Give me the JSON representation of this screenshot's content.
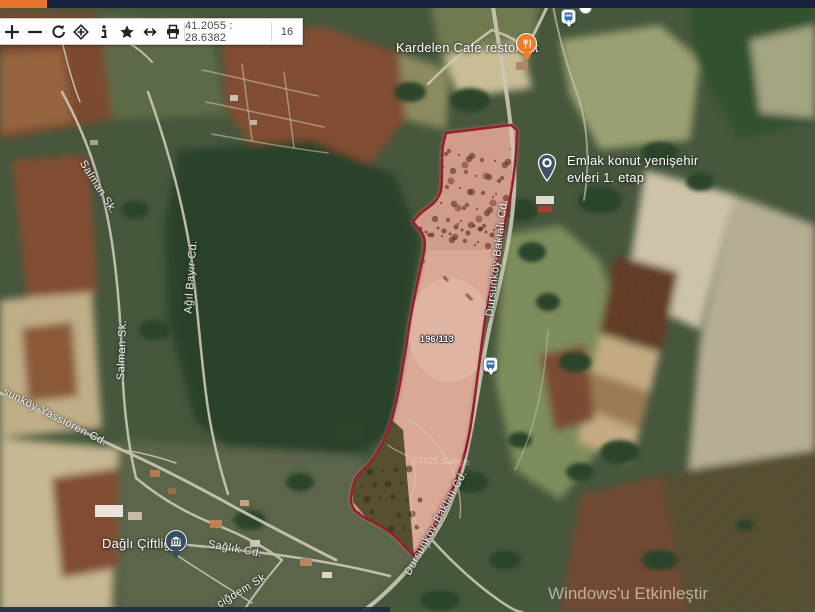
{
  "chrome": {
    "topbar_color": "#17233e",
    "tab_color": "#e8732a"
  },
  "toolbar": {
    "icons": [
      "zoom-in",
      "zoom-out",
      "refresh",
      "locate",
      "info",
      "favorite",
      "measure",
      "print"
    ],
    "coordinates": "41.2055 : 28.6382",
    "zoom_level": "16"
  },
  "map": {
    "markers": {
      "cafe": {
        "label": "Kardelen Cafe restorant",
        "color": "#f07d26"
      },
      "estate": {
        "line1": "Emlak konut yenişehir",
        "line2": "evleri 1. etap",
        "color": "#3d5266"
      },
      "farm": {
        "label": "Dağlı Çiftliği",
        "color": "#33505f"
      }
    },
    "parcel": {
      "number": "196/113",
      "stroke_color": "#9d1c2c"
    },
    "roads": {
      "baklali_upper": "Dursunköy-Baklalı Cd.",
      "baklali_lower": "Dursunköy-Baklalı Cd.",
      "salman_upper": "Salman Sk.",
      "salman_lower": "Salman Sk.",
      "agil_bayir": "Ağıl Bayır Cd.",
      "yassioren": "sunköy-Yassiören Cd.",
      "saglik": "Sağlık Cd.",
      "cigdem": "çiğdem Sk."
    },
    "attribution": "©2025 Google",
    "os_watermark": "Windows'u Etkinleştir"
  }
}
